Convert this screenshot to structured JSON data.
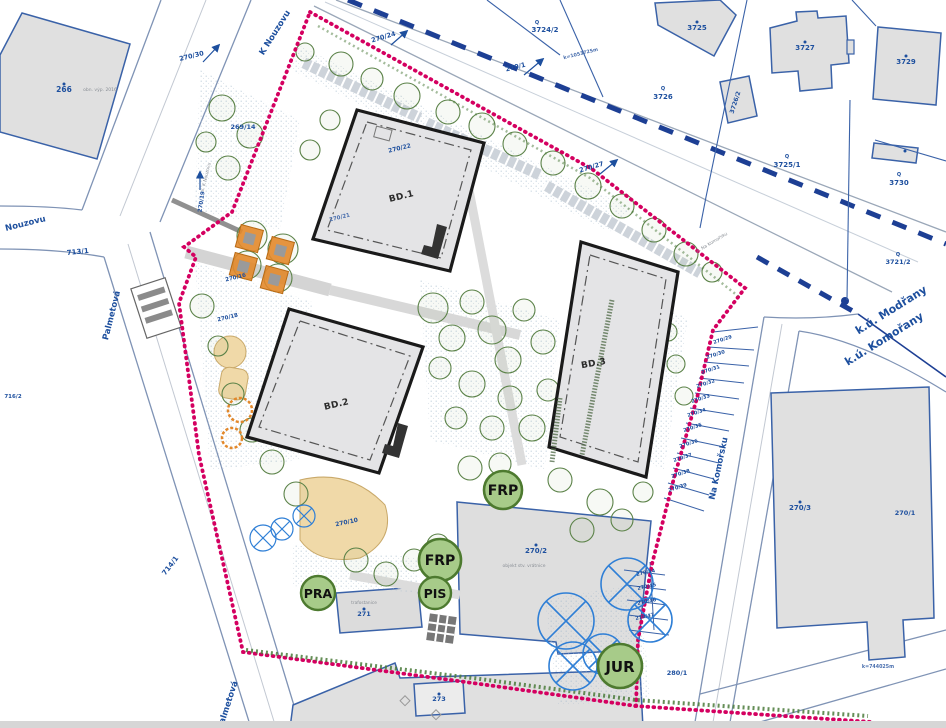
{
  "colors": {
    "site_boundary_red": "#d40060",
    "cadastral_line_navy": "#1d3f94",
    "parcel_line_blue": "#3a62a8",
    "label_blue": "#1d4f9e",
    "building_outline": "#1a1a1a",
    "building_fill": "#e4e4e6",
    "parcel_fill": "#e0e0e0",
    "badge_fill": "#a7cb89",
    "badge_border": "#4d7a2f",
    "tree_green": "#5b8248",
    "orange": "#e2882b",
    "beige": "#f0d9a8",
    "removed_tree_blue": "#2f7fd6",
    "hedge_green": "#4a7a3a"
  },
  "buildings": {
    "bd1": "BD.1",
    "bd2": "BD.2",
    "bd3": "BD.3"
  },
  "badges": {
    "frp1": "FRP",
    "frp2": "FRP",
    "pis": "PIS",
    "pra": "PRA",
    "jur": "JUR"
  },
  "streets": {
    "k_nouzovu": "K Nouzovu",
    "nouzovu": "Nouzovu",
    "palmetova": "Palmetová",
    "palmetova2": "Palmetová",
    "na_komorsku": "Na Komořsku",
    "ul_na_komorsku": "ul. Na Komořsku",
    "ul_k_nouzovu": "ul. K Nouzovu"
  },
  "cadastre": {
    "modrany": "k.ú. Modřany",
    "komorany": "k.ú. Komořany"
  },
  "parcels": {
    "p266": "266",
    "p270_30": "270/30",
    "p269_14": "269/14",
    "p270_24": "270/24",
    "p3724_2": "3724/2",
    "p270_1": "270/1",
    "p3725": "3725",
    "p3727": "3727",
    "p3729": "3729",
    "p3726": "3726",
    "p3726_2": "3726/2",
    "p3725_1": "3725/1",
    "p3730": "3730",
    "p270_27": "270/27",
    "p3721_2": "3721/2",
    "p270_22": "270/22",
    "p270_21": "270/21",
    "p713_1": "713/1",
    "p716_2": "716/2",
    "p270_19": "270/19",
    "p270_16": "270/16",
    "p270_18": "270/18",
    "p714_1": "714/1",
    "p270_10": "270/10",
    "p270_2": "270/2",
    "p271": "271",
    "p273": "273",
    "p280_1": "280/1",
    "p270_3": "270/3",
    "p270_1r": "270/1"
  },
  "strip": [
    "270/29",
    "270/30",
    "270/31",
    "270/32",
    "270/33",
    "270/34",
    "270/35",
    "270/36",
    "270/37",
    "270/38",
    "270/39"
  ],
  "strip2": [
    "270/44",
    "270/45",
    "270/46",
    "270/47"
  ],
  "notes": {
    "trafostanice": "trafostanice",
    "vratnice": "objekt stv. vrátnice",
    "obn": "obn. výp. 2016",
    "k1": "k=1053725m",
    "k2": "k=744025m"
  },
  "symbol_q": "Q"
}
